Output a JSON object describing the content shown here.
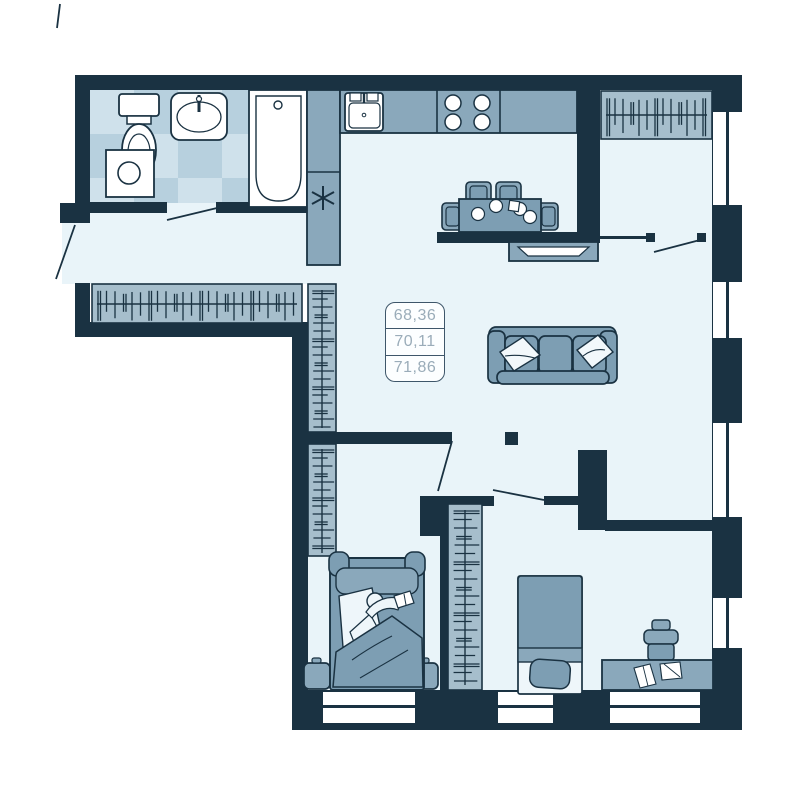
{
  "plan": {
    "area_values": [
      "68,36",
      "70,11",
      "71,86"
    ]
  },
  "palette": {
    "wall": "#1a3242",
    "floor": "#e9f4f9",
    "tile_light": "#cfe1eb",
    "tile_dark": "#b7d0de",
    "wardrobe": "#a6becc",
    "furniture": "#7d9eb3",
    "furniture_alt": "#8aa8bb",
    "fixture_white": "#ffffff",
    "label_text": "#9aacb9"
  },
  "icons": {
    "ventilation": "asterisk-icon",
    "hangers": "clothes-hanger-hatch"
  }
}
